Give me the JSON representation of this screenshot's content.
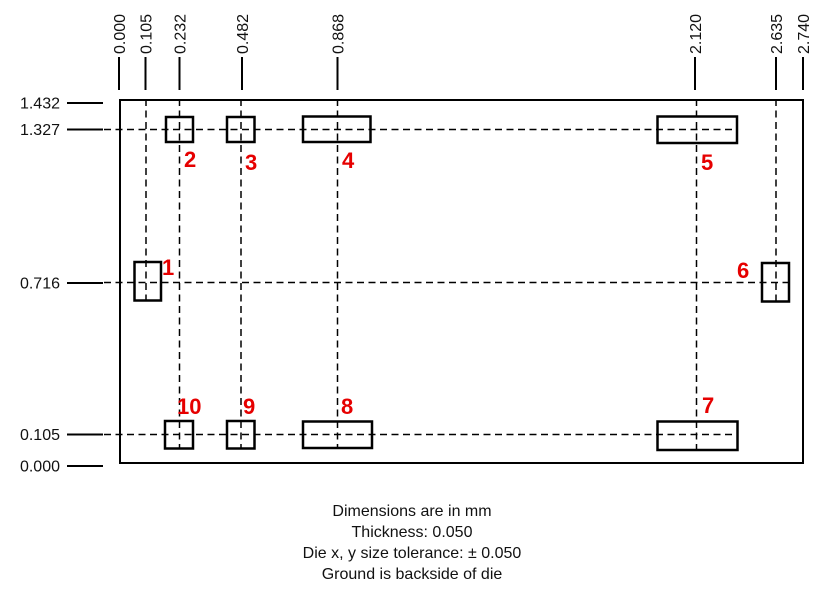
{
  "diagram_title": "die pad layout",
  "units": "mm",
  "die": {
    "width_mm": "2.740",
    "height_mm": "1.432"
  },
  "axes": {
    "top": {
      "labels": [
        "0.000",
        "0.105",
        "0.232",
        "0.482",
        "0.868",
        "2.120",
        "2.635",
        "2.740"
      ]
    },
    "left": {
      "labels": [
        "1.432",
        "1.327",
        "0.716",
        "0.105",
        "0.000"
      ]
    }
  },
  "pads": [
    {
      "number": "1",
      "x_mm": "0.105",
      "y_mm": "0.716"
    },
    {
      "number": "2",
      "x_mm": "0.232",
      "y_mm": "1.327"
    },
    {
      "number": "3",
      "x_mm": "0.482",
      "y_mm": "1.327"
    },
    {
      "number": "4",
      "x_mm": "0.868",
      "y_mm": "1.327"
    },
    {
      "number": "5",
      "x_mm": "2.120",
      "y_mm": "1.327"
    },
    {
      "number": "6",
      "x_mm": "2.635",
      "y_mm": "0.716"
    },
    {
      "number": "7",
      "x_mm": "2.120",
      "y_mm": "0.105"
    },
    {
      "number": "8",
      "x_mm": "0.868",
      "y_mm": "0.105"
    },
    {
      "number": "9",
      "x_mm": "0.482",
      "y_mm": "0.105"
    },
    {
      "number": "10",
      "x_mm": "0.232",
      "y_mm": "0.105"
    }
  ],
  "notes": {
    "line1": "Dimensions are in mm",
    "line2": "Thickness: 0.050",
    "line3": "Die x, y size tolerance: ± 0.050",
    "line4": "Ground is backside of die"
  },
  "colors": {
    "line": "#000000",
    "pad_number": "#e60000",
    "background": "#ffffff"
  }
}
